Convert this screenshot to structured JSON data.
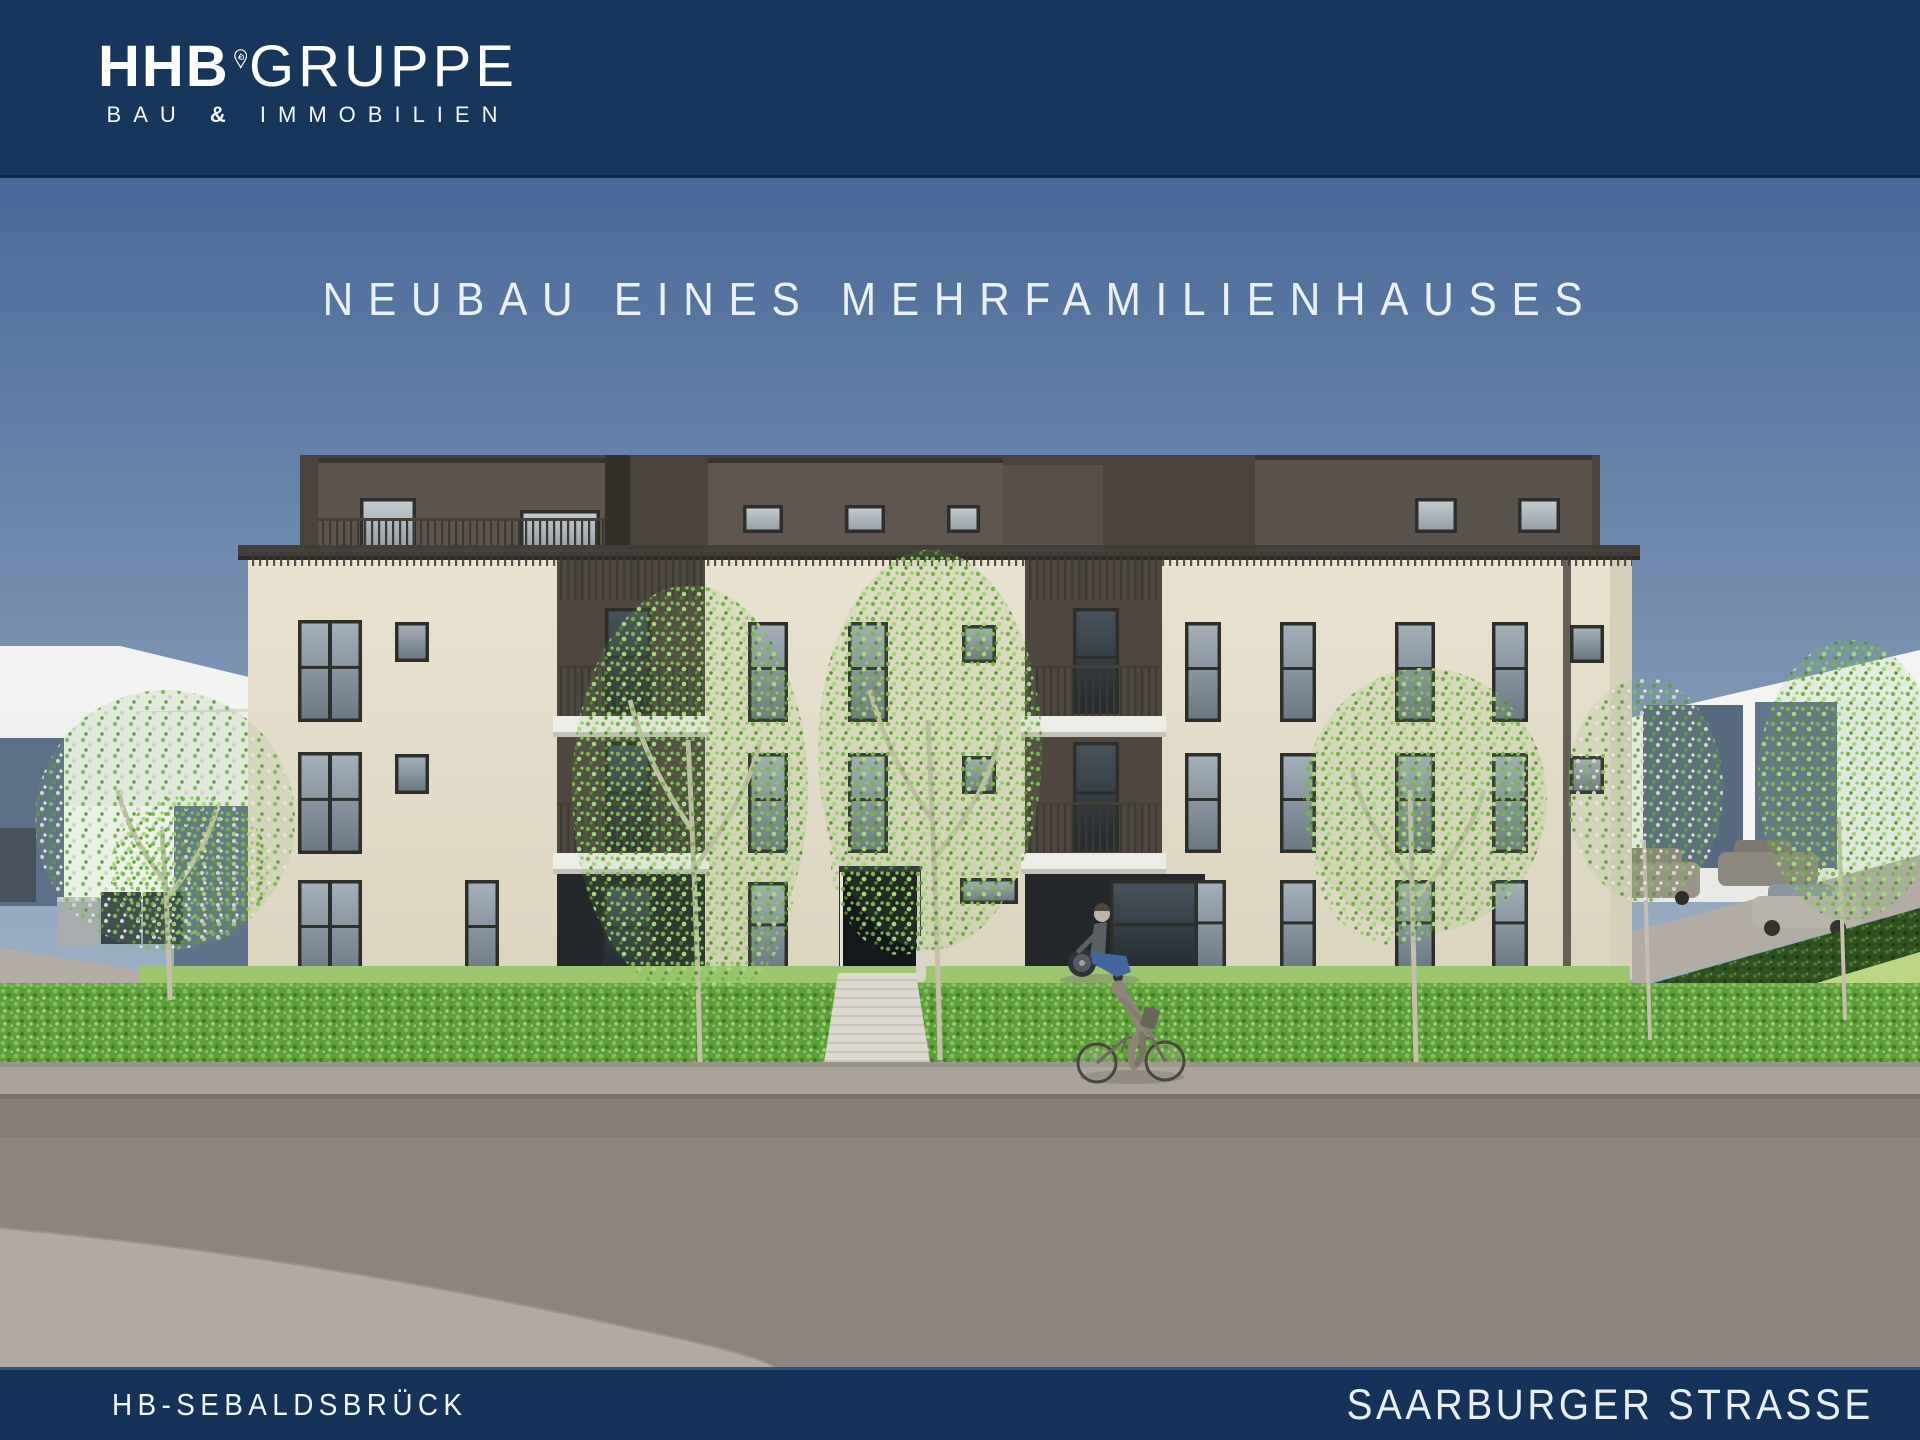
{
  "header": {
    "brand_bold": "HHB",
    "brand_light": "GRUPPE",
    "tagline": {
      "left": "BAU",
      "amp": "&",
      "right": "IMMOBILIEN"
    },
    "pin_icon": "location-pin-house-icon"
  },
  "hero": {
    "title": "NEUBAU EINES MEHRFAMILIENHAUSES"
  },
  "footer": {
    "location_left": "HB-SEBALDSBRÜCK",
    "location_right": "SAARBURGER STRASSE"
  },
  "colors": {
    "navy_bar": "#16365c",
    "footer_bar": "#14325a",
    "title_text": "#e9f0f7",
    "sky_top": "#486a99",
    "sky_bottom": "#a9bac9",
    "facade_cream": "#e6dfcb",
    "penthouse_brown": "#5b534c",
    "recess_dark": "#4e463f",
    "hedge_green": "#5f9e3d",
    "lawn_green": "#8fbf60",
    "sidewalk_gray": "#a9a29c",
    "road_gray": "#8c847e"
  },
  "scene": {
    "type": "architectural-rendering",
    "elements": [
      "apartment-building",
      "penthouse-level",
      "balconies",
      "entrance-door",
      "entrance-path",
      "front-hedge",
      "lawn",
      "street-trees",
      "cyclist",
      "wheelchair-user",
      "neighbor-house-left",
      "neighbor-houses-right",
      "parked-cars",
      "waste-bins",
      "sidewalk",
      "road"
    ]
  }
}
